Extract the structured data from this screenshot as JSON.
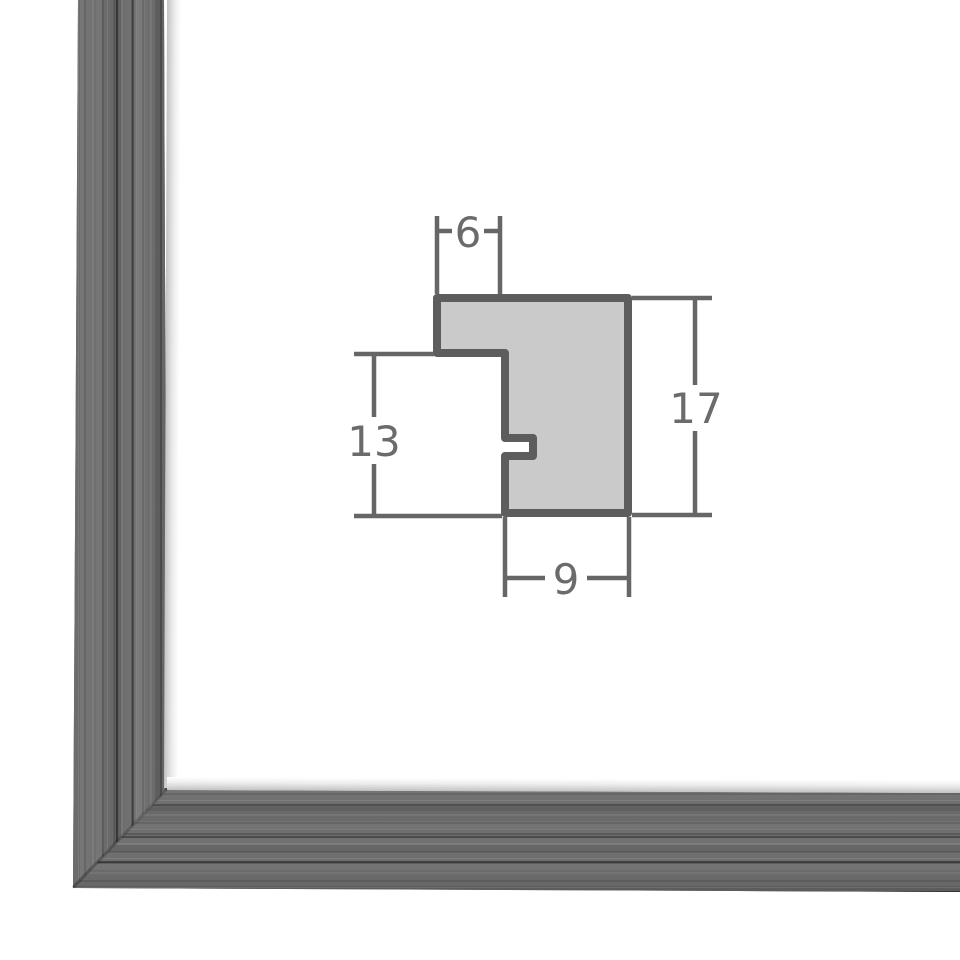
{
  "page": {
    "background": "#ffffff"
  },
  "frame_photo": {
    "subject": "brushed gray wood picture frame corner",
    "base_color": "#6e6e6e",
    "dark_grain_color": "#3f3f3f",
    "light_grain_color": "#9c9c9c",
    "inner_lip_color": "#c3c3c3"
  },
  "diagram": {
    "kind": "moulding-profile-cross-section",
    "outline_color": "#5d5d5d",
    "fill_color": "#cacaca",
    "dimension_line_color": "#666666",
    "label_color": "#6b6b6b",
    "labels": {
      "top": "6",
      "left": "13",
      "right": "17",
      "bottom": "9"
    }
  }
}
